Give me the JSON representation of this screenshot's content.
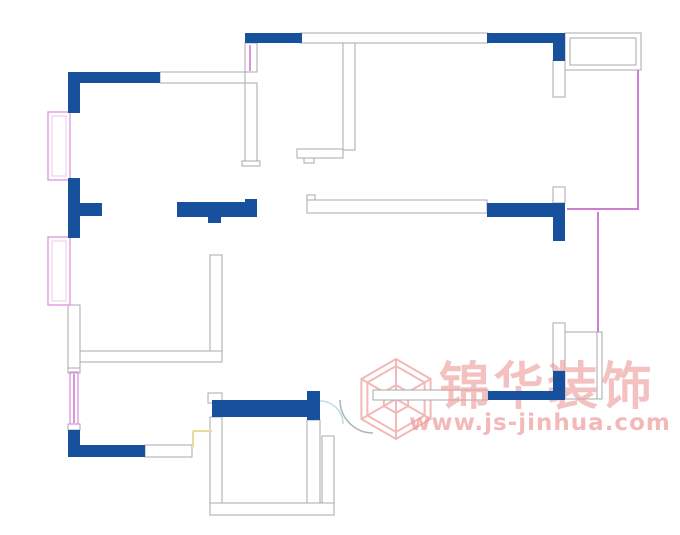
{
  "watermark": {
    "brand_text": "锦华装饰",
    "url_text": "www.js-jinhua.com",
    "text_color": "#ee9c9c",
    "logo_color": "#f2b9b9",
    "logo": {
      "cx": 396,
      "cy": 399,
      "radii": [
        40,
        33,
        14
      ]
    }
  },
  "palette": {
    "wall_blue": "#17509d",
    "wall_outline": "#a9a9ad",
    "wall_fill": "#ffffff",
    "window_pink": "#dd93dc",
    "window_pink_inner": "#efc7ec",
    "balcony_pink": "#cf7fd2",
    "door_yellow": "#e8dc9a",
    "door_cyan": "#bfe0e4",
    "door_gray": "#b5b5ba",
    "background": "#ffffff"
  },
  "floorplan_data": {
    "canvas": {
      "width": 680,
      "height": 535
    },
    "outlined_walls": [
      [
        300,
        33,
        188,
        10
      ],
      [
        160,
        72,
        85,
        11
      ],
      [
        245,
        43,
        12,
        29
      ],
      [
        245,
        83,
        12,
        78
      ],
      [
        242,
        161,
        18,
        5
      ],
      [
        343,
        43,
        12,
        107
      ],
      [
        297,
        149,
        46,
        9
      ],
      [
        304,
        158,
        10,
        5
      ],
      [
        553,
        60,
        12,
        37
      ],
      [
        553,
        187,
        12,
        16
      ],
      [
        307,
        200,
        180,
        13
      ],
      [
        307,
        195,
        8,
        5
      ],
      [
        210,
        255,
        12,
        97
      ],
      [
        80,
        351,
        142,
        11
      ],
      [
        68,
        305,
        12,
        63
      ],
      [
        68,
        368,
        12,
        5
      ],
      [
        68,
        424,
        12,
        6
      ],
      [
        145,
        445,
        47,
        12
      ],
      [
        208,
        393,
        14,
        10
      ],
      [
        210,
        417,
        12,
        88
      ],
      [
        210,
        503,
        124,
        12
      ],
      [
        307,
        420,
        13,
        83
      ],
      [
        322,
        436,
        12,
        67
      ],
      [
        373,
        390,
        115,
        10
      ],
      [
        553,
        323,
        12,
        48
      ]
    ],
    "outline_rects": [
      [
        565,
        33,
        76,
        37
      ],
      [
        570,
        38,
        66,
        27
      ],
      [
        565,
        332,
        37,
        67
      ]
    ],
    "gray_lines": [
      [
        597,
        332,
        597,
        399
      ]
    ],
    "blue_walls": [
      [
        245,
        33,
        57,
        10
      ],
      [
        487,
        33,
        78,
        10
      ],
      [
        553,
        43,
        12,
        18
      ],
      [
        68,
        72,
        92,
        11
      ],
      [
        68,
        83,
        12,
        30
      ],
      [
        68,
        178,
        12,
        60
      ],
      [
        80,
        203,
        22,
        13
      ],
      [
        177,
        202,
        80,
        15
      ],
      [
        245,
        199,
        12,
        4
      ],
      [
        208,
        217,
        13,
        6
      ],
      [
        487,
        203,
        78,
        14
      ],
      [
        553,
        217,
        12,
        24
      ],
      [
        68,
        430,
        12,
        27
      ],
      [
        68,
        445,
        77,
        12
      ],
      [
        212,
        400,
        108,
        17
      ],
      [
        307,
        391,
        13,
        29
      ],
      [
        488,
        391,
        77,
        9
      ],
      [
        553,
        371,
        12,
        29
      ]
    ],
    "balcony_pink_lines": [
      [
        638,
        70,
        638,
        210
      ],
      [
        567,
        209,
        638,
        209
      ],
      [
        598,
        212,
        598,
        332
      ]
    ],
    "light_pink_lines": [
      [
        250,
        45,
        250,
        71
      ],
      [
        74,
        374,
        74,
        423
      ]
    ],
    "window_rects_outer": [
      [
        48,
        112,
        22,
        68
      ],
      [
        48,
        237,
        22,
        68
      ],
      [
        70,
        372,
        8,
        52
      ]
    ],
    "window_rects_inner": [
      [
        52,
        116,
        14,
        60
      ],
      [
        52,
        241,
        14,
        60
      ]
    ],
    "yellow_lines": [
      [
        193,
        431,
        212,
        431
      ],
      [
        193,
        431,
        193,
        447
      ]
    ],
    "door_arcs": [
      {
        "d": "M 340 400 A 33 33 0 0 0 373 433",
        "color": "door_gray"
      },
      {
        "d": "M 320 401 A 23 23 0 0 1 343 424",
        "color": "door_cyan"
      }
    ]
  }
}
